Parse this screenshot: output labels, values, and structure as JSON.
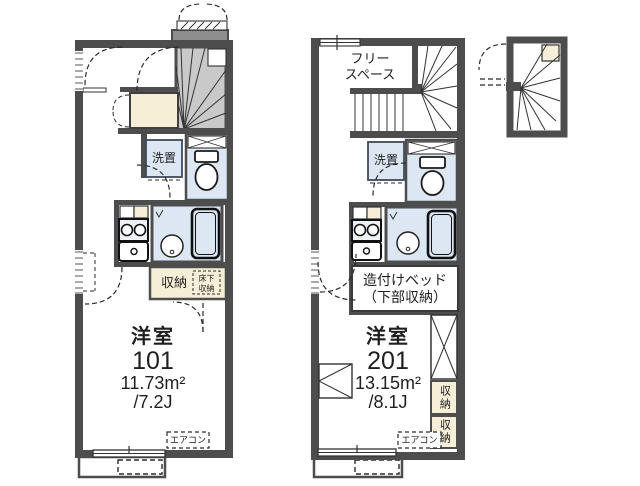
{
  "colors": {
    "wall": "#4d4d4d",
    "stair_gray": "#c9c9c9",
    "porch_gray": "#8e8e8e",
    "closet_beige": "#f6eed6",
    "wet_area_blue": "#dce7f3",
    "text": "#1f1f1f"
  },
  "unit101": {
    "room_type": "洋室",
    "room_number": "101",
    "area_sqm": "11.73m²",
    "area_tatami": "/7.2J",
    "washer_label": "洗置",
    "storage_label": "収納",
    "underfloor_storage_line1": "床下",
    "underfloor_storage_line2": "収納",
    "aircon_label": "エアコン"
  },
  "unit201": {
    "room_type": "洋室",
    "room_number": "201",
    "area_sqm": "13.15m²",
    "area_tatami": "/8.1J",
    "free_space_line1": "フリー",
    "free_space_line2": "スペース",
    "washer_label": "洗置",
    "bed_label_line1": "造付けベッド",
    "bed_label_line2": "（下部収納）",
    "storage_label_top": "収納",
    "storage_label_bottom": "収納",
    "aircon_label": "エアコン"
  }
}
